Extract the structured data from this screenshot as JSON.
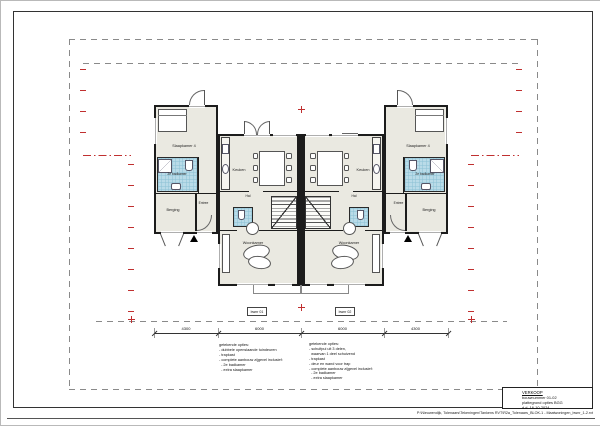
{
  "drawing": {
    "rooms": {
      "bedroom": "Slaapkamer 4",
      "bathroom": "2e badkamer",
      "storage": "Berging",
      "entry": "Entree",
      "kitchen": "Keuken",
      "hall": "Hal",
      "living": "Woonkamer"
    },
    "units": [
      {
        "label": "bwnr 01"
      },
      {
        "label": "bwnr 02"
      }
    ],
    "dimensions": [
      "4300",
      "6000",
      "6000",
      "4300"
    ],
    "options_left": {
      "lines": [
        "getekende opties:",
        "- dubbele openslaande tuindeuren",
        "- trapkast",
        "- complete aanbouw zijgevel inclusief:",
        "  - 2e badkamer",
        "  - extra slaapkamer"
      ]
    },
    "options_right": {
      "lines": [
        "getekende opties:",
        "- schuifpui uit 3 delen,",
        "  waarvan 1 deel schuivend",
        "- trapkast",
        "- deur en wand voor trap",
        "- complete aanbouw zijgevel inclusief:",
        "  - 2e badkamer",
        "  - extra slaapkamer"
      ]
    }
  },
  "title_block": {
    "status": "VERKOOP",
    "bouwnummer": "bouwnummer 01-02",
    "plattegrond": "plattegrond opties BGG",
    "date": "d.d. 16-10-2024"
  },
  "footer": {
    "file_path": "P:\\Nieuwendijk, Tolenaars\\Tekeningen\\Tankens RVT\\R2a_Tolenaars_BLOK-1 - Maatwoningen_bwnr_1-2.rvt"
  },
  "colors": {
    "wall": "#1c1c1c",
    "room_fill": "#eae9e1",
    "tile_blue": "#b9dbe8",
    "boundary_red": "#c03030",
    "dashed_gray": "#8a8a8a"
  }
}
